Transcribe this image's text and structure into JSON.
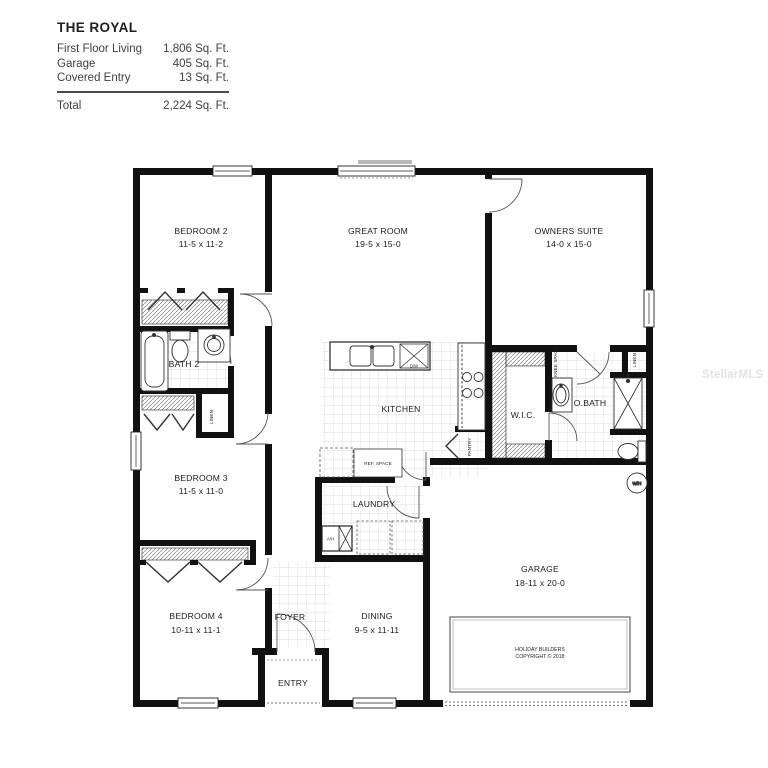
{
  "watermark": "StellarMLS",
  "header": {
    "title": "THE ROYAL",
    "rows": [
      {
        "label": "First Floor Living",
        "value": "1,806 Sq. Ft."
      },
      {
        "label": "Garage",
        "value": "405 Sq. Ft."
      },
      {
        "label": "Covered Entry",
        "value": "13 Sq. Ft."
      }
    ],
    "total_label": "Total",
    "total_value": "2,224 Sq. Ft."
  },
  "rooms": {
    "bedroom2": {
      "name": "BEDROOM 2",
      "dims": "11-5 x 11-2"
    },
    "great_room": {
      "name": "GREAT ROOM",
      "dims": "19-5 x 15-0"
    },
    "owners_suite": {
      "name": "OWNERS SUITE",
      "dims": "14-0 x 15-0"
    },
    "bath2": {
      "name": "BATH 2"
    },
    "bedroom3": {
      "name": "BEDROOM 3",
      "dims": "11-5 x 11-0"
    },
    "kitchen": {
      "name": "KITCHEN"
    },
    "wic": {
      "name": "W.I.C."
    },
    "obath": {
      "name": "O.BATH"
    },
    "laundry": {
      "name": "LAUNDRY"
    },
    "bedroom4": {
      "name": "BEDROOM 4",
      "dims": "10-11 x 11-1"
    },
    "foyer": {
      "name": "FOYER"
    },
    "dining": {
      "name": "DINING",
      "dims": "9-5 x 11-11"
    },
    "entry": {
      "name": "ENTRY"
    },
    "garage": {
      "name": "GARAGE",
      "dims": "18-11 x 20-0"
    }
  },
  "annotations": {
    "ref_space": "REF. SPACE",
    "pantry": "PANTRY",
    "linen_hall": "LINEN",
    "linen_bath": "LINEN",
    "knee_space": "KNEE SPACE",
    "air_handler": "A/H",
    "water_heater": "W/H",
    "dishwasher": "D/W",
    "copyright_line1": "HOLIDAY BUILDERS",
    "copyright_line2": "COPYRIGHT © 2018"
  },
  "colors": {
    "wall": "#111111",
    "tile_line": "#d4d4d4",
    "watermark": "#e3e3e3"
  }
}
